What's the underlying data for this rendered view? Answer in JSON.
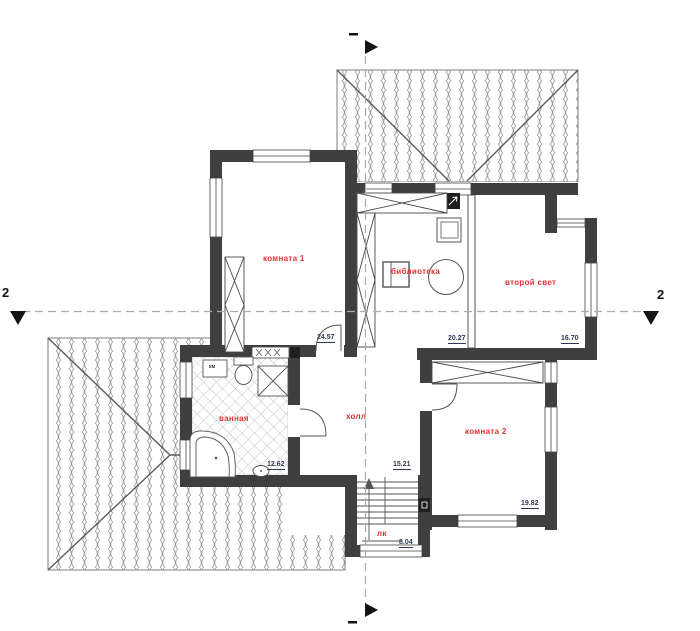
{
  "plan": {
    "title": "second floor plan",
    "axis": {
      "section_label": "2"
    },
    "rooms": [
      {
        "id": "room1",
        "name": "комната 1",
        "area": "24.57"
      },
      {
        "id": "library",
        "name": "библиотека",
        "area": "20.27"
      },
      {
        "id": "second-light",
        "name": "второй свет",
        "area": "16.70"
      },
      {
        "id": "bathroom",
        "name": "ванная",
        "area": "12.62"
      },
      {
        "id": "hall",
        "name": "холл",
        "area": "15.21"
      },
      {
        "id": "room2",
        "name": "комната 2",
        "area": "19.82"
      },
      {
        "id": "stairs",
        "name": "лк",
        "area": "8.04"
      }
    ],
    "fixtures": {
      "washer_label": "км"
    },
    "colors": {
      "wall": "#3f3f3f",
      "room_label": "#e03434",
      "area_text": "#2e3a55",
      "axis_line": "#ababab",
      "roof_pattern": "#9a9a9a",
      "marker": "#141414"
    }
  }
}
